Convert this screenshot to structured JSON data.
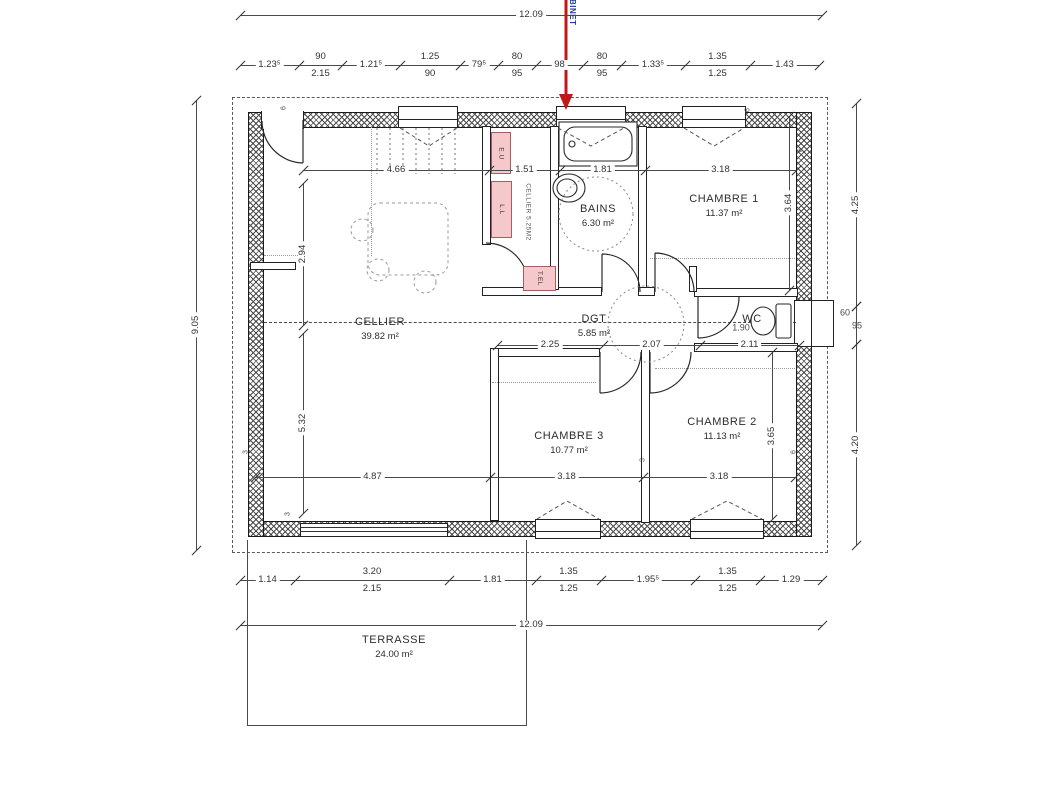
{
  "annotation": {
    "text": "ROBINET",
    "text_color": "#1e3b9a",
    "arrow_color": "#c01818"
  },
  "rooms": {
    "cellier": {
      "name": "CELLIER",
      "area": "39.82 m²"
    },
    "pantry": {
      "name": "CELLIER 5.25M2"
    },
    "bains": {
      "name": "BAINS",
      "area": "6.30 m²"
    },
    "chambre1": {
      "name": "CHAMBRE 1",
      "area": "11.37 m²"
    },
    "chambre2": {
      "name": "CHAMBRE 2",
      "area": "11.13 m²"
    },
    "chambre3": {
      "name": "CHAMBRE 3",
      "area": "10.77 m²"
    },
    "dgt": {
      "name": "DGT",
      "area": "5.85 m²"
    },
    "wc": {
      "name": "WC",
      "area": ""
    },
    "terrasse": {
      "name": "TERRASSE",
      "area": "24.00 m²"
    }
  },
  "equipment": [
    {
      "label": "E.U"
    },
    {
      "label": "L.L"
    },
    {
      "label": "T.EL"
    }
  ],
  "colors": {
    "equipment_fill": "#f5c8cb",
    "equipment_border": "#a85c60",
    "arrow": "#c01818",
    "annotation_text": "#1e3b9a",
    "wall_line": "#1a1a1a",
    "dim_line": "#4a4a4a"
  },
  "dim_chains": [
    {
      "name": "dim-top-overall",
      "y": 15,
      "x1": 240,
      "segs": [
        {
          "t": "12.09",
          "w": 582
        }
      ]
    },
    {
      "name": "dim-top-chain",
      "y": 65,
      "x1": 240,
      "segs": [
        {
          "t": "1.23⁵",
          "w": 59
        },
        {
          "t": "90",
          "b": "2.15",
          "w": 43
        },
        {
          "t": "1.21⁵",
          "w": 58
        },
        {
          "t": "1.25",
          "b": "90",
          "w": 60
        },
        {
          "t": "79⁵",
          "w": 38
        },
        {
          "t": "80",
          "b": "95",
          "w": 38
        },
        {
          "t": "98",
          "w": 47
        },
        {
          "t": "80",
          "b": "95",
          "w": 38
        },
        {
          "t": "1.33⁵",
          "w": 64
        },
        {
          "t": "1.35",
          "b": "1.25",
          "w": 65
        },
        {
          "t": "1.43",
          "w": 69
        }
      ]
    },
    {
      "name": "dim-row-upper",
      "y": 170,
      "x1": 303,
      "segs": [
        {
          "t": "4.66",
          "w": 186
        },
        {
          "t": "1.51",
          "w": 71
        },
        {
          "t": "1.81",
          "w": 85
        },
        {
          "t": "3.18",
          "w": 151
        }
      ]
    },
    {
      "name": "dim-row-middle",
      "y": 345,
      "x1": 497,
      "segs": [
        {
          "t": "2.25",
          "w": 106
        },
        {
          "t": "2.07",
          "w": 97
        },
        {
          "t": "2.11",
          "w": 99
        }
      ]
    },
    {
      "name": "dim-row-lower",
      "y": 477,
      "x1": 255,
      "segs": [
        {
          "t": "4.87",
          "w": 235
        },
        {
          "t": "3.18",
          "w": 153
        },
        {
          "t": "3.18",
          "w": 152
        }
      ]
    },
    {
      "name": "dim-bottom-chain",
      "y": 580,
      "x1": 240,
      "segs": [
        {
          "t": "1.14",
          "w": 55
        },
        {
          "t": "3.20",
          "b": "2.15",
          "w": 154
        },
        {
          "t": "1.81",
          "w": 87
        },
        {
          "t": "1.35",
          "b": "1.25",
          "w": 65
        },
        {
          "t": "1.95⁵",
          "w": 94
        },
        {
          "t": "1.35",
          "b": "1.25",
          "w": 65
        },
        {
          "t": "1.29",
          "w": 62
        }
      ]
    },
    {
      "name": "dim-bottom-overall",
      "y": 625,
      "x1": 240,
      "segs": [
        {
          "t": "12.09",
          "w": 582
        }
      ]
    }
  ],
  "dim_vlines": [
    {
      "name": "dim-left-overall",
      "t": "9.05",
      "x": 196,
      "y1": 100,
      "y2": 550
    },
    {
      "name": "dim-left-upper",
      "t": "2.94",
      "x": 303,
      "y1": 183,
      "y2": 325
    },
    {
      "name": "dim-left-lower",
      "t": "5.32",
      "x": 303,
      "y1": 333,
      "y2": 513
    },
    {
      "name": "dim-chambre1-height",
      "t": "3.64",
      "x": 789,
      "y1": 116,
      "y2": 290
    },
    {
      "name": "dim-chambre2-height",
      "t": "3.65",
      "x": 772,
      "y1": 352,
      "y2": 519
    },
    {
      "name": "dim-right-upper",
      "t": "4.25",
      "x": 856,
      "y1": 103,
      "y2": 306
    },
    {
      "name": "dim-right-window",
      "t": "",
      "x": 856,
      "y1": 306,
      "y2": 344
    },
    {
      "name": "dim-right-lower",
      "t": "4.20",
      "x": 856,
      "y1": 344,
      "y2": 545
    }
  ],
  "free_labels": [
    {
      "t": "60",
      "x": 845,
      "y": 313,
      "s": 9,
      "name": "dim-window-width"
    },
    {
      "t": "95",
      "x": 857,
      "y": 326,
      "s": 9,
      "name": "dim-window-height"
    },
    {
      "t": "1.90",
      "x": 741,
      "y": 328,
      "s": 9,
      "name": "dim-wc-width"
    },
    {
      "t": "6",
      "x": 284,
      "y": 108,
      "r": -90,
      "s": 7,
      "name": "wall-mark"
    },
    {
      "t": "6",
      "x": 748,
      "y": 110,
      "r": -90,
      "s": 7,
      "name": "wall-mark"
    },
    {
      "t": "6",
      "x": 801,
      "y": 150,
      "r": -90,
      "s": 7,
      "name": "wall-mark"
    },
    {
      "t": "6",
      "x": 794,
      "y": 452,
      "r": -90,
      "s": 7,
      "name": "wall-mark"
    },
    {
      "t": "3",
      "x": 288,
      "y": 514,
      "r": -90,
      "s": 7,
      "name": "wall-mark"
    },
    {
      "t": "3",
      "x": 246,
      "y": 452,
      "r": -90,
      "s": 7,
      "name": "wall-mark"
    },
    {
      "t": "3",
      "x": 643,
      "y": 460,
      "r": -90,
      "s": 7,
      "name": "wall-mark"
    }
  ]
}
